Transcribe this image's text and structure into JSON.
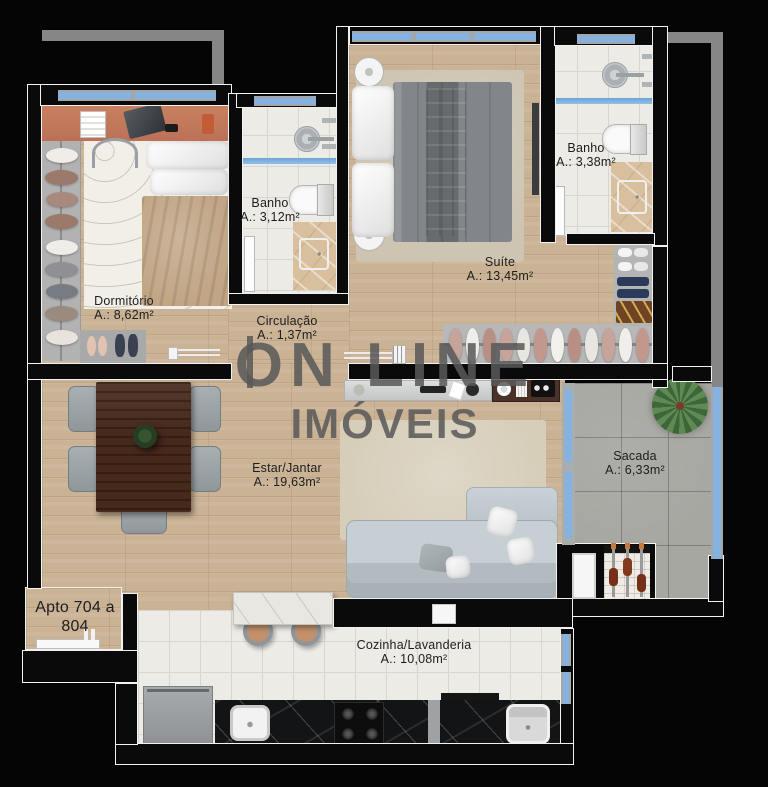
{
  "plan": {
    "unit": {
      "line1": "Apto 704 a",
      "line2": "804"
    },
    "watermark": {
      "line1": "ON LINE",
      "line2": "IMÓVEIS"
    },
    "rooms": [
      {
        "name": "Dormitório",
        "area": "A.: 8,62m²"
      },
      {
        "name": "Banho",
        "area": "A.: 3,12m²"
      },
      {
        "name": "Circulação",
        "area": "A.: 1,37m²"
      },
      {
        "name": "Suíte",
        "area": "A.: 13,45m²"
      },
      {
        "name": "Banho",
        "area": "A.: 3,38m²"
      },
      {
        "name": "Estar/Jantar",
        "area": "A.: 19,63m²"
      },
      {
        "name": "Sacada",
        "area": "A.: 6,33m²"
      },
      {
        "name": "Cozinha/Lavanderia",
        "area": "A.: 10,08m²"
      }
    ],
    "colors": {
      "wood": "#cab295",
      "bath_tile": "#edebe5",
      "balcony_tile": "#a7a7a2",
      "glass": "#85b2e0",
      "wall": "#0a0a0a",
      "outline": "#f2f2f2",
      "desk_accent": "#c0795f",
      "black_counter": "#131416"
    }
  }
}
